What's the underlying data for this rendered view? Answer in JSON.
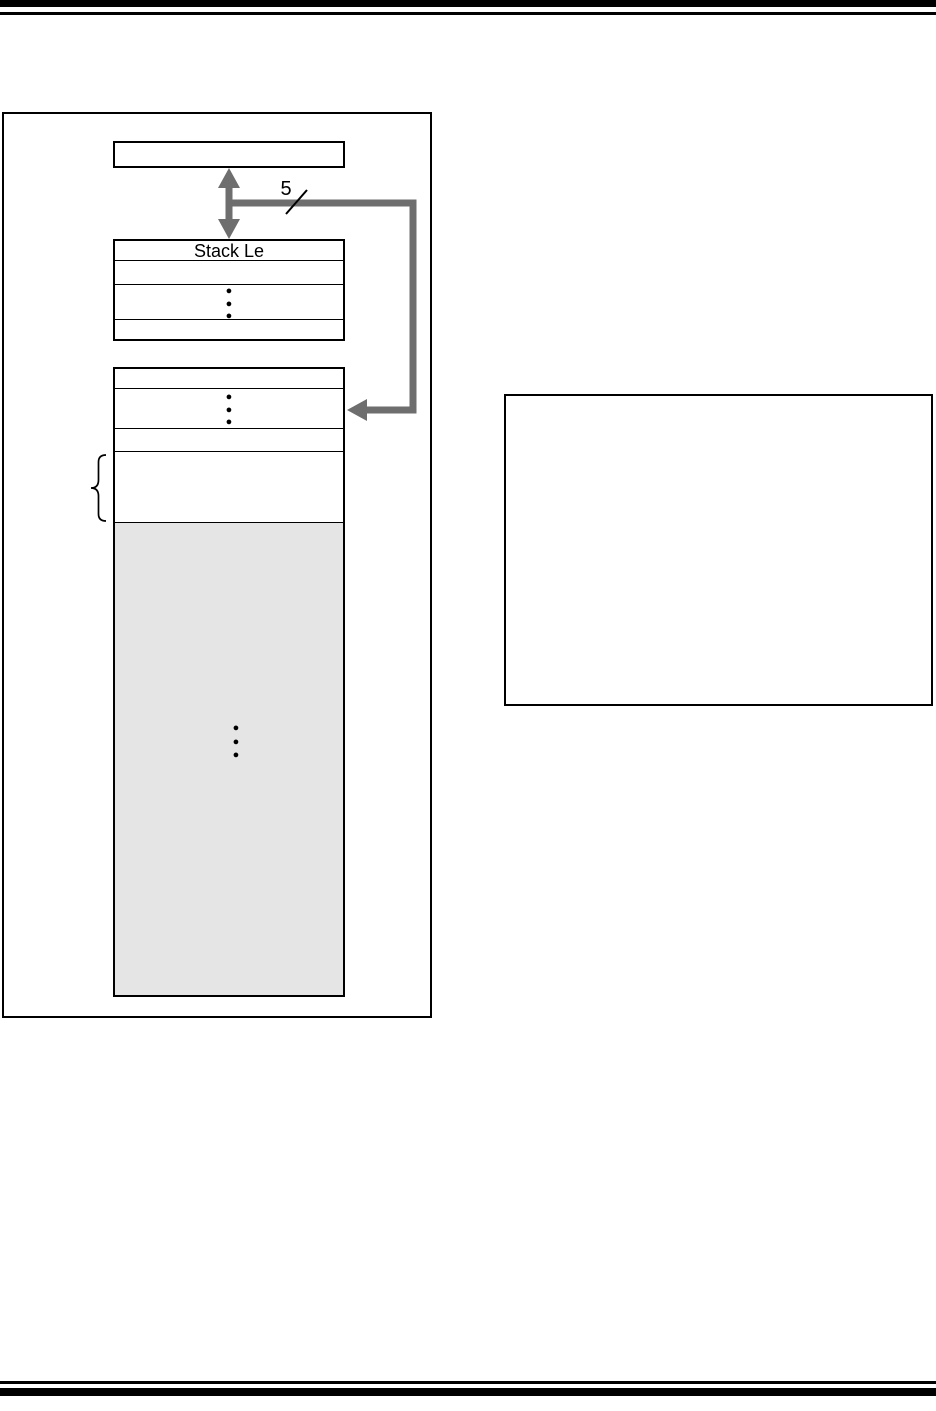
{
  "colors": {
    "ink": "#000000",
    "arrow_gray": "#6e6e6e",
    "shade_gray": "#e5e5e5",
    "paper": "#ffffff"
  },
  "glyphs": {
    "dot": "●"
  },
  "figure": {
    "register_box": {
      "label": ""
    },
    "bus": {
      "width_label": "5"
    },
    "stack_level_table": {
      "header": "Stack Le",
      "row2": "",
      "row4": ""
    },
    "memory_table": {
      "row1": "",
      "row3": "",
      "braced_row": ""
    },
    "shaded_region": {
      "label": ""
    },
    "note_box": {
      "content": ""
    }
  }
}
